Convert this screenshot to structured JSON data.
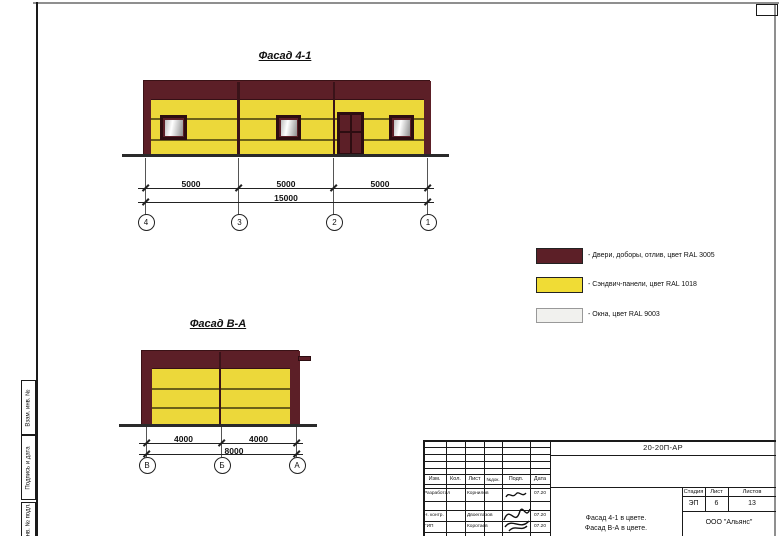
{
  "colors": {
    "doors_ral3005": "#5c1f27",
    "panels_ral1018": "#ecd83a",
    "windows_ral9003": "#f1f1ee"
  },
  "sheet": {
    "margin_labels": [
      "Взам. инв. №",
      "Подпись и дата",
      "Инв. № подл."
    ]
  },
  "facade_41": {
    "title": "Фасад 4-1",
    "dims": [
      "5000",
      "5000",
      "5000"
    ],
    "total": "15000",
    "axes": [
      "4",
      "3",
      "2",
      "1"
    ]
  },
  "facade_va": {
    "title": "Фасад В-А",
    "dims": [
      "4000",
      "4000"
    ],
    "total": "8000",
    "axes": [
      "В",
      "Б",
      "А"
    ]
  },
  "legend": {
    "items": [
      {
        "label": "- Двери, доборы, отлив, цвет RAL 3005"
      },
      {
        "label": "- Сэндвич-панели, цвет RAL 1018"
      },
      {
        "label": "- Окна, цвет RAL 9003"
      }
    ]
  },
  "title_block": {
    "doc_number": "20-20П-АР",
    "columns": [
      "Изм.",
      "Кол.",
      "Лист",
      "№док.",
      "Подп.",
      "Дата"
    ],
    "rows": [
      {
        "role": "Разработал",
        "name": "Корнилов",
        "date": "07.20"
      },
      {
        "role": "Н. контр.",
        "name": "Двоеглазов",
        "date": "07.20"
      },
      {
        "role": "ГИП",
        "name": "Коротаев",
        "date": "07.20"
      }
    ],
    "stage_cols": [
      "Стадия",
      "Лист",
      "Листов"
    ],
    "stage": "ЭП",
    "sheet_no": "6",
    "sheets_total": "13",
    "subject": [
      "Фасад 4-1 в цвете.",
      "Фасад В-А в цвете."
    ],
    "company": "ООО \"Альянс\""
  }
}
